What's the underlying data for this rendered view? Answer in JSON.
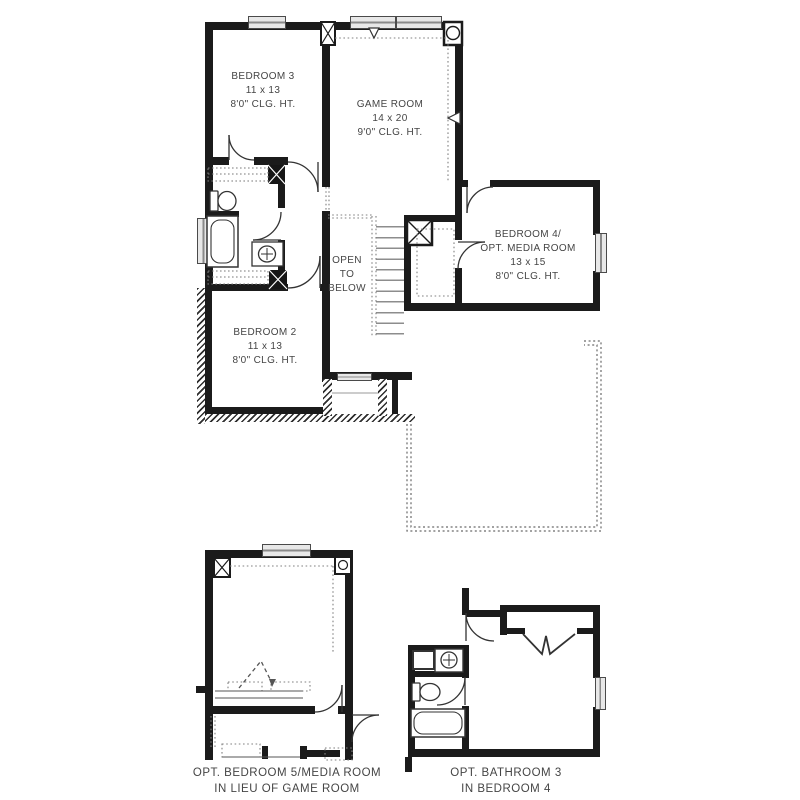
{
  "colors": {
    "wall": "#1b1b1b",
    "window": "#e8e8e8",
    "text": "#454545",
    "dotted": "#7a7a7a"
  },
  "floorplan": {
    "rooms": {
      "bedroom3": {
        "name": "BEDROOM 3",
        "dims": "11 x 13",
        "ceiling": "8'0\" CLG. HT."
      },
      "gameroom": {
        "name": "GAME ROOM",
        "dims": "14 x 20",
        "ceiling": "9'0\" CLG. HT."
      },
      "bedroom4": {
        "name": "BEDROOM 4/",
        "alt": "OPT. MEDIA ROOM",
        "dims": "13 x 15",
        "ceiling": "8'0\" CLG. HT."
      },
      "bedroom2": {
        "name": "BEDROOM 2",
        "dims": "11 x 13",
        "ceiling": "8'0\" CLG. HT."
      },
      "stairwell": {
        "line1": "OPEN",
        "line2": "TO",
        "line3": "BELOW"
      }
    },
    "options": {
      "bedroom5": {
        "line1": "OPT. BEDROOM 5/MEDIA ROOM",
        "line2": "IN LIEU OF GAME ROOM"
      },
      "bathroom3": {
        "line1": "OPT. BATHROOM 3",
        "line2": "IN BEDROOM 4"
      }
    }
  }
}
